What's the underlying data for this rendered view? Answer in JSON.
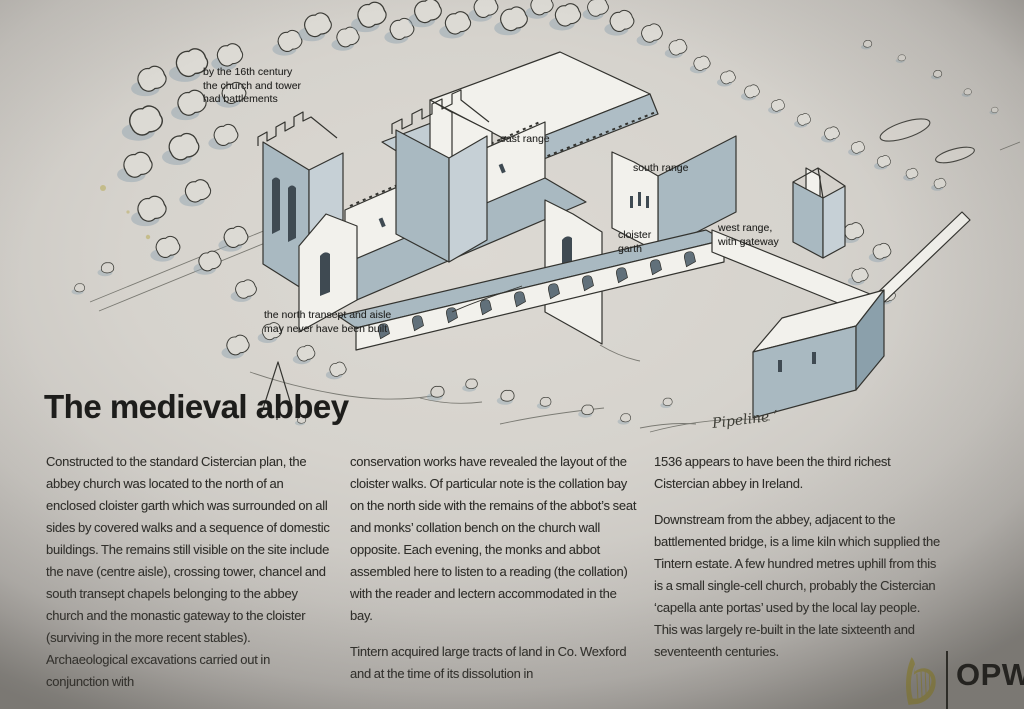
{
  "panel": {
    "title": "The medieval abbey",
    "columns": [
      {
        "paragraphs": [
          "Constructed to the standard Cistercian plan, the abbey church was located to the north of an enclosed cloister garth which was surrounded on all sides by covered walks and a sequence of domestic buildings. The remains still visible on the site include the nave (centre aisle), crossing tower, chancel and south transept chapels belonging to the abbey church and the monastic gateway to the cloister (surviving in the more recent stables). Archaeological excavations carried out in conjunction with"
        ]
      },
      {
        "paragraphs": [
          "conservation works have revealed the layout of the cloister walks. Of particular note is the collation bay on the north side with the remains of the abbot’s seat and monks’ collation bench on the church wall opposite. Each evening, the monks and abbot assembled here to listen to a reading (the collation) with the reader and lectern accommodated in the bay.",
          "Tintern acquired large tracts of land in Co. Wexford and at the time of its dissolution in"
        ]
      },
      {
        "paragraphs": [
          "1536 appears to have been the third richest Cistercian abbey in Ireland.",
          "Downstream from the abbey, adjacent to the battlemented bridge, is a lime kiln which supplied the Tintern estate. A few hundred metres uphill from this is a small single-cell church, probably the Cistercian ‘capella ante portas’ used by the local lay people. This was largely re-built in the late sixteenth and seventeenth centuries."
        ]
      }
    ]
  },
  "illustration": {
    "labels": {
      "battlements": "by the 16th century\nthe church and tower\nhad battlements",
      "east_range": "east range",
      "south_range": "south range",
      "cloister_garth": "cloister\ngarth",
      "west_range": "west range,\nwith gateway",
      "north_transept": "the north transept and aisle\nmay never have been built"
    },
    "signature": "Pipeline ’",
    "colors": {
      "roof_blue_grey": "#a9b9c1",
      "wall_white": "#f2f1ec",
      "ink": "#33332f",
      "shadow_blue": "#93a6b1"
    }
  },
  "footer": {
    "logo_text": "OPW",
    "harp_icon": "irish-state-harp",
    "harp_color": "#a3984e"
  }
}
